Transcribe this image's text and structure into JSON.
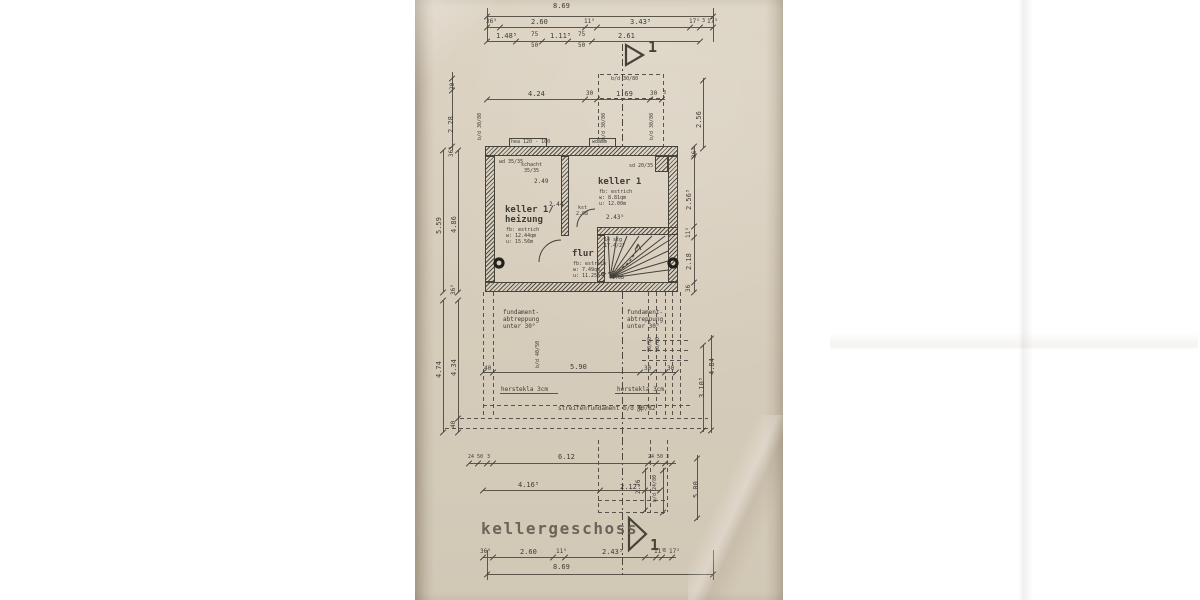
{
  "document": {
    "title": "kellergeschoss",
    "sheet_marker": "1",
    "drawing_type": "basement floor plan, scanned paper blueprint"
  },
  "palette": {
    "paper": "#d7cdbc",
    "ink": "#45423a",
    "title_ink": "#615d50"
  },
  "rooms": [
    {
      "name": "keller 1/heizung",
      "floor": "fb: estrich",
      "area": "w: 12.44qm",
      "perimeter": "u: 15.56m"
    },
    {
      "name": "keller 1",
      "floor": "fb: estrich",
      "area": "w: 8.81qm",
      "perimeter": "u: 12.00m"
    },
    {
      "name": "flur",
      "floor": "fb: estrich",
      "area": "w: 7.49qm",
      "perimeter": "u: 11.25m"
    }
  ],
  "stair": {
    "note": "14 stg 17.4/27"
  },
  "plan": {
    "labels": [
      {
        "t": "8.69",
        "x": 553,
        "y": 3
      },
      {
        "t": "36⁵",
        "x": 486,
        "y": 19,
        "s": 6
      },
      {
        "t": "2.60",
        "x": 531,
        "y": 19
      },
      {
        "t": "11⁵",
        "x": 584,
        "y": 19,
        "s": 6
      },
      {
        "t": "3.43⁵",
        "x": 630,
        "y": 19
      },
      {
        "t": "17⁵",
        "x": 689,
        "y": 19,
        "s": 6
      },
      {
        "t": "3",
        "x": 702,
        "y": 19,
        "s": 5
      },
      {
        "t": "17⁵",
        "x": 707,
        "y": 19,
        "s": 6
      },
      {
        "t": "1.48⁵",
        "x": 496,
        "y": 33
      },
      {
        "t": "75",
        "x": 531,
        "y": 32,
        "s": 6
      },
      {
        "t": "50",
        "x": 531,
        "y": 43,
        "s": 6
      },
      {
        "t": "1.11⁵",
        "x": 550,
        "y": 33
      },
      {
        "t": "75",
        "x": 578,
        "y": 32,
        "s": 6
      },
      {
        "t": "50",
        "x": 578,
        "y": 43,
        "s": 6
      },
      {
        "t": "2.61",
        "x": 618,
        "y": 33
      },
      {
        "t": "4.24",
        "x": 528,
        "y": 91
      },
      {
        "t": "30",
        "x": 586,
        "y": 91,
        "s": 6
      },
      {
        "t": "1.69",
        "x": 616,
        "y": 91
      },
      {
        "t": "30",
        "x": 650,
        "y": 91,
        "s": 6
      },
      {
        "t": "3",
        "x": 663,
        "y": 91,
        "s": 5
      },
      {
        "t": "b/d 30/80",
        "x": 611,
        "y": 77,
        "s": 5
      },
      {
        "t": "b/d 30/80",
        "x": 602,
        "y": 140,
        "s": 5,
        "r": 1
      },
      {
        "t": "b/d 30/80",
        "x": 650,
        "y": 140,
        "s": 5,
        "r": 1
      },
      {
        "t": "b/d 30/80",
        "x": 478,
        "y": 140,
        "s": 5,
        "r": 1
      },
      {
        "t": "20",
        "x": 450,
        "y": 90,
        "s": 6,
        "r": 1
      },
      {
        "t": "2.28",
        "x": 448,
        "y": 133,
        "r": 1
      },
      {
        "t": "36⁵",
        "x": 449,
        "y": 157,
        "s": 6,
        "r": 1
      },
      {
        "t": "5.59",
        "x": 436,
        "y": 234,
        "r": 1
      },
      {
        "t": "4.86",
        "x": 451,
        "y": 233,
        "r": 1
      },
      {
        "t": "36⁵",
        "x": 451,
        "y": 295,
        "s": 6,
        "r": 1
      },
      {
        "t": "4.74",
        "x": 436,
        "y": 378,
        "r": 1
      },
      {
        "t": "4.34",
        "x": 451,
        "y": 376,
        "r": 1
      },
      {
        "t": "40",
        "x": 451,
        "y": 428,
        "s": 6,
        "r": 1
      },
      {
        "t": "2.56",
        "x": 696,
        "y": 128,
        "r": 1
      },
      {
        "t": "36⁵",
        "x": 692,
        "y": 158,
        "s": 6,
        "r": 1
      },
      {
        "t": "2.56⁵",
        "x": 686,
        "y": 210,
        "r": 1
      },
      {
        "t": "11⁵",
        "x": 686,
        "y": 238,
        "s": 6,
        "r": 1
      },
      {
        "t": "2.18",
        "x": 686,
        "y": 270,
        "r": 1
      },
      {
        "t": "36",
        "x": 686,
        "y": 292,
        "s": 6,
        "r": 1
      },
      {
        "t": "3.10⁵",
        "x": 699,
        "y": 398,
        "r": 1
      },
      {
        "t": "4.84",
        "x": 709,
        "y": 375,
        "r": 1
      },
      {
        "t": "5.00",
        "x": 693,
        "y": 498,
        "r": 1
      },
      {
        "t": "2.76",
        "x": 636,
        "y": 494,
        "s": 6,
        "r": 1
      },
      {
        "t": "b/d 24/80",
        "x": 653,
        "y": 502,
        "s": 5,
        "r": 1
      },
      {
        "t": "hea 120 - 100",
        "x": 511,
        "y": 140,
        "s": 5
      },
      {
        "t": "wdämm",
        "x": 592,
        "y": 140,
        "s": 5
      },
      {
        "t": "wd 35/35",
        "x": 499,
        "y": 160,
        "s": 5
      },
      {
        "t": "schacht",
        "x": 521,
        "y": 163,
        "s": 5
      },
      {
        "t": "35/35",
        "x": 524,
        "y": 169,
        "s": 5
      },
      {
        "t": "sd 20/35",
        "x": 629,
        "y": 164,
        "s": 5
      },
      {
        "t": "keller 1/",
        "x": 505,
        "y": 206,
        "s": 9,
        "b": 1,
        "n": "room-label-heizung"
      },
      {
        "t": "heizung",
        "x": 505,
        "y": 216,
        "s": 9,
        "b": 1,
        "n": "room-label-heizung"
      },
      {
        "t": "fb: estrich",
        "x": 506,
        "y": 228,
        "s": 5
      },
      {
        "t": "w: 12.44qm",
        "x": 506,
        "y": 234,
        "s": 5
      },
      {
        "t": "u: 15.56m",
        "x": 506,
        "y": 240,
        "s": 5
      },
      {
        "t": "keller 1",
        "x": 598,
        "y": 178,
        "s": 9,
        "b": 1,
        "n": "room-label-keller1"
      },
      {
        "t": "fb: estrich",
        "x": 599,
        "y": 190,
        "s": 5
      },
      {
        "t": "w: 8.81qm",
        "x": 599,
        "y": 196,
        "s": 5
      },
      {
        "t": "u: 12.00m",
        "x": 599,
        "y": 202,
        "s": 5
      },
      {
        "t": "flur",
        "x": 572,
        "y": 250,
        "s": 9,
        "b": 1,
        "n": "room-label-flur"
      },
      {
        "t": "fb: estrich",
        "x": 573,
        "y": 262,
        "s": 5
      },
      {
        "t": "w: 7.49qm",
        "x": 573,
        "y": 268,
        "s": 5
      },
      {
        "t": "u: 11.25m",
        "x": 573,
        "y": 274,
        "s": 5
      },
      {
        "t": "14 stg",
        "x": 604,
        "y": 238,
        "s": 5
      },
      {
        "t": "17.4/27",
        "x": 604,
        "y": 244,
        "s": 5
      },
      {
        "t": "1.08",
        "x": 612,
        "y": 276,
        "s": 5
      },
      {
        "t": "2.49",
        "x": 534,
        "y": 179,
        "s": 6
      },
      {
        "t": "2.44",
        "x": 549,
        "y": 202,
        "s": 6
      },
      {
        "t": "2.43⁵",
        "x": 606,
        "y": 215,
        "s": 6
      },
      {
        "t": "kst",
        "x": 578,
        "y": 206,
        "s": 5
      },
      {
        "t": "2.08",
        "x": 576,
        "y": 212,
        "s": 5
      },
      {
        "t": "fundament-",
        "x": 503,
        "y": 310,
        "s": 6
      },
      {
        "t": "abtreppung",
        "x": 503,
        "y": 317,
        "s": 6
      },
      {
        "t": "unter 30°",
        "x": 503,
        "y": 324,
        "s": 6
      },
      {
        "t": "fundament-",
        "x": 627,
        "y": 310,
        "s": 6
      },
      {
        "t": "abtreppung",
        "x": 627,
        "y": 317,
        "s": 6
      },
      {
        "t": "unter 30°",
        "x": 627,
        "y": 324,
        "s": 6
      },
      {
        "t": "40",
        "x": 484,
        "y": 366,
        "s": 6
      },
      {
        "t": "5.90",
        "x": 570,
        "y": 364
      },
      {
        "t": "30",
        "x": 644,
        "y": 366,
        "s": 6
      },
      {
        "t": "30",
        "x": 667,
        "y": 366,
        "s": 6
      },
      {
        "t": "30/80",
        "x": 648,
        "y": 352,
        "s": 5,
        "r": 1
      },
      {
        "t": "50/80",
        "x": 656,
        "y": 352,
        "s": 5,
        "r": 1
      },
      {
        "t": "b/d 40/50",
        "x": 536,
        "y": 368,
        "s": 5,
        "r": 1
      },
      {
        "t": "herstekla 3cm",
        "x": 501,
        "y": 387,
        "s": 6
      },
      {
        "t": "herstekla 3cm",
        "x": 617,
        "y": 387,
        "s": 6
      },
      {
        "t": "streifenfundament b/d 40/82",
        "x": 558,
        "y": 406,
        "s": 6
      },
      {
        "t": "50",
        "x": 638,
        "y": 412,
        "s": 6,
        "r": 1
      },
      {
        "t": "24",
        "x": 468,
        "y": 455,
        "s": 5
      },
      {
        "t": "50",
        "x": 477,
        "y": 455,
        "s": 5
      },
      {
        "t": "3",
        "x": 487,
        "y": 455,
        "s": 5
      },
      {
        "t": "6.12",
        "x": 558,
        "y": 454
      },
      {
        "t": "24",
        "x": 648,
        "y": 455,
        "s": 5
      },
      {
        "t": "50",
        "x": 657,
        "y": 455,
        "s": 5
      },
      {
        "t": "3",
        "x": 666,
        "y": 455,
        "s": 5
      },
      {
        "t": "4.16⁵",
        "x": 518,
        "y": 482
      },
      {
        "t": "2.12⁵",
        "x": 620,
        "y": 484
      },
      {
        "t": "36⁵",
        "x": 480,
        "y": 549,
        "s": 6
      },
      {
        "t": "2.60",
        "x": 520,
        "y": 549
      },
      {
        "t": "11⁵",
        "x": 556,
        "y": 549,
        "s": 6
      },
      {
        "t": "2.43⁵",
        "x": 602,
        "y": 549
      },
      {
        "t": "11⁵",
        "x": 654,
        "y": 549,
        "s": 6
      },
      {
        "t": "3",
        "x": 663,
        "y": 549,
        "s": 5
      },
      {
        "t": "17⁵",
        "x": 669,
        "y": 549,
        "s": 6
      },
      {
        "t": "8.69",
        "x": 553,
        "y": 564
      }
    ]
  }
}
